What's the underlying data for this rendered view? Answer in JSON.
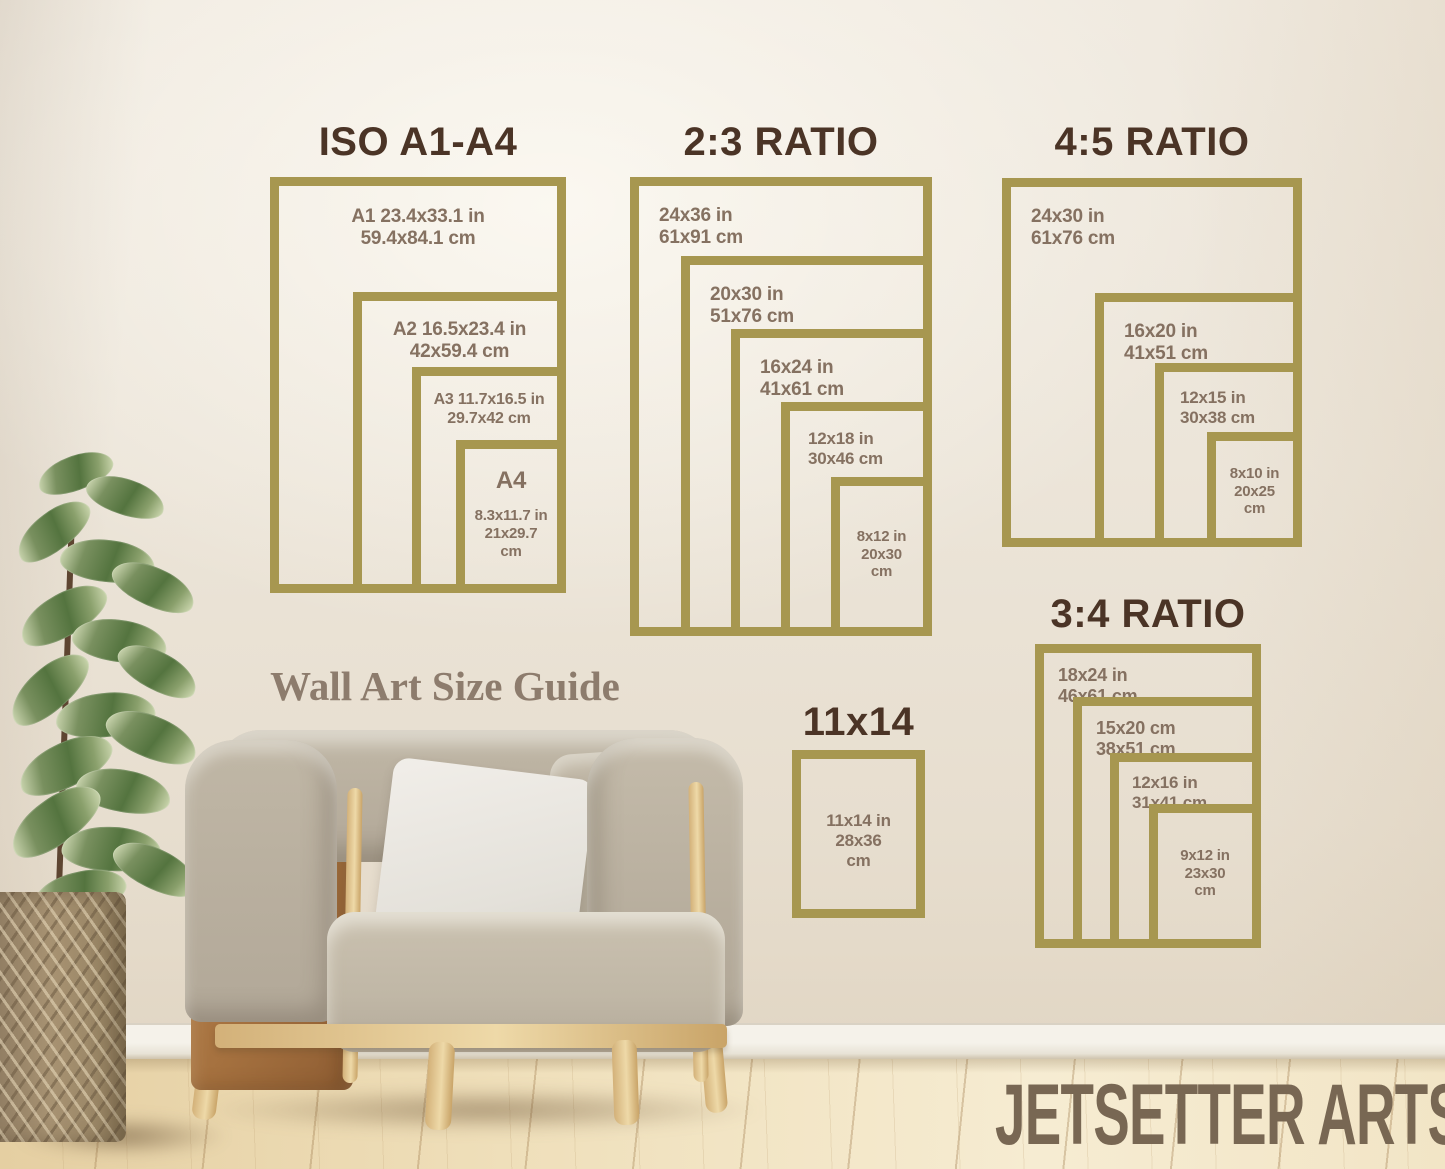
{
  "scene": {
    "caption": "Wall Art Size Guide",
    "brand": "JETSETTER ARTS"
  },
  "groups": {
    "iso": {
      "title": "ISO A1-A4",
      "frames": [
        {
          "l1": "A1 23.4x33.1 in",
          "l2": "59.4x84.1 cm"
        },
        {
          "l1": "A2 16.5x23.4 in",
          "l2": "42x59.4 cm"
        },
        {
          "l1": "A3 11.7x16.5 in",
          "l2": "29.7x42 cm"
        },
        {
          "h": "A4",
          "l1": "8.3x11.7 in",
          "l2": "21x29.7",
          "l3": "cm"
        }
      ]
    },
    "r23": {
      "title": "2:3 RATIO",
      "frames": [
        {
          "l1": "24x36 in",
          "l2": "61x91 cm"
        },
        {
          "l1": "20x30 in",
          "l2": "51x76 cm"
        },
        {
          "l1": "16x24 in",
          "l2": "41x61 cm"
        },
        {
          "l1": "12x18 in",
          "l2": "30x46 cm"
        },
        {
          "l1": "8x12 in",
          "l2": "20x30",
          "l3": "cm"
        }
      ]
    },
    "r45": {
      "title": "4:5 RATIO",
      "frames": [
        {
          "l1": "24x30 in",
          "l2": "61x76 cm"
        },
        {
          "l1": "16x20 in",
          "l2": "41x51 cm"
        },
        {
          "l1": "12x15 in",
          "l2": "30x38 cm"
        },
        {
          "l1": "8x10 in",
          "l2": "20x25",
          "l3": "cm"
        }
      ]
    },
    "r34": {
      "title": "3:4 RATIO",
      "frames": [
        {
          "l1": "18x24 in",
          "l2": "46x61 cm"
        },
        {
          "l1": "15x20 cm",
          "l2": "38x51 cm"
        },
        {
          "l1": "12x16 in",
          "l2": "31x41 cm"
        },
        {
          "l1": "9x12 in",
          "l2": "23x30",
          "l3": "cm"
        }
      ]
    },
    "s11": {
      "title": "11x14",
      "frames": [
        {
          "l1": "11x14 in",
          "l2": "28x36",
          "l3": "cm"
        }
      ]
    }
  },
  "colors": {
    "frame_gold": "#a79750",
    "title_brown": "#4b3426",
    "label_brown": "#857161",
    "caption_brown": "#8d7c6d",
    "brand_brown": "#786753",
    "wall_cream": "#ebe4d8",
    "floor_wood_light": "#f6ecd2",
    "floor_wood_dark": "#e5cfa2"
  }
}
